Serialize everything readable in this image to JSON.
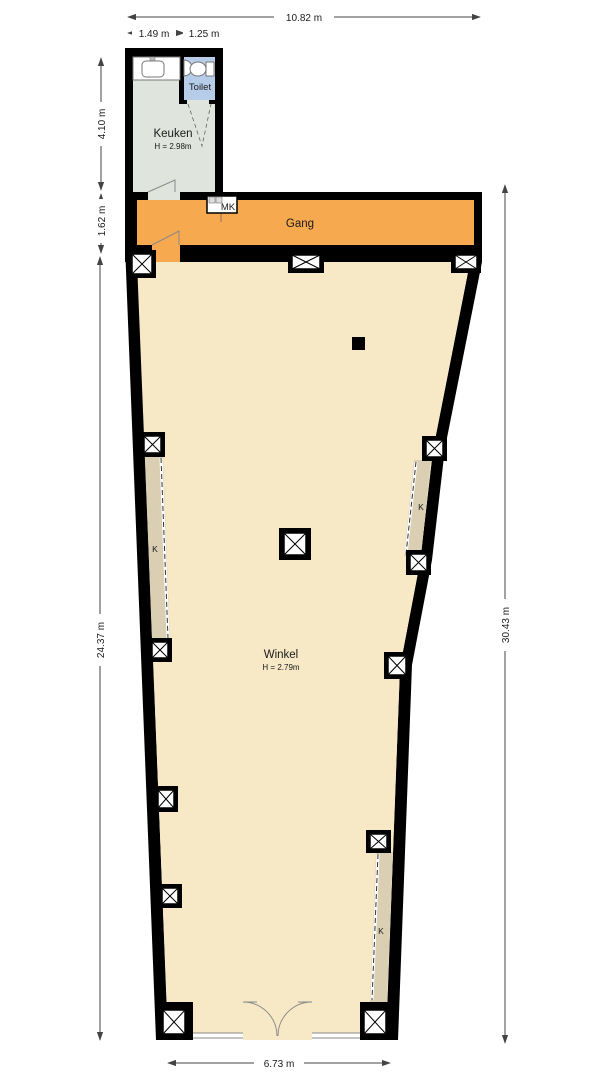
{
  "rooms": {
    "keuken": {
      "label": "Keuken",
      "height": "H = 2.98m"
    },
    "toilet": {
      "label": "Toilet"
    },
    "gang": {
      "label": "Gang"
    },
    "winkel": {
      "label": "Winkel",
      "height": "H = 2.79m"
    }
  },
  "annotations": {
    "meter_closet": "MK",
    "closets": [
      "K",
      "K",
      "K"
    ]
  },
  "dimensions": {
    "top_total": "10.82 m",
    "top_seg1": "1.49 m",
    "top_seg2": "1.25 m",
    "left_top": "4.10 m",
    "left_mid": "1.62 m",
    "left_main": "24.37 m",
    "right_main": "30.43 m",
    "bottom": "6.73 m"
  },
  "colors": {
    "wall": "#000000",
    "keuken": "#dfe4dc",
    "toilet": "#b7cce8",
    "gang": "#f7a94f",
    "winkel": "#f7e9c6",
    "closet_strip": "#dbcfb3"
  }
}
